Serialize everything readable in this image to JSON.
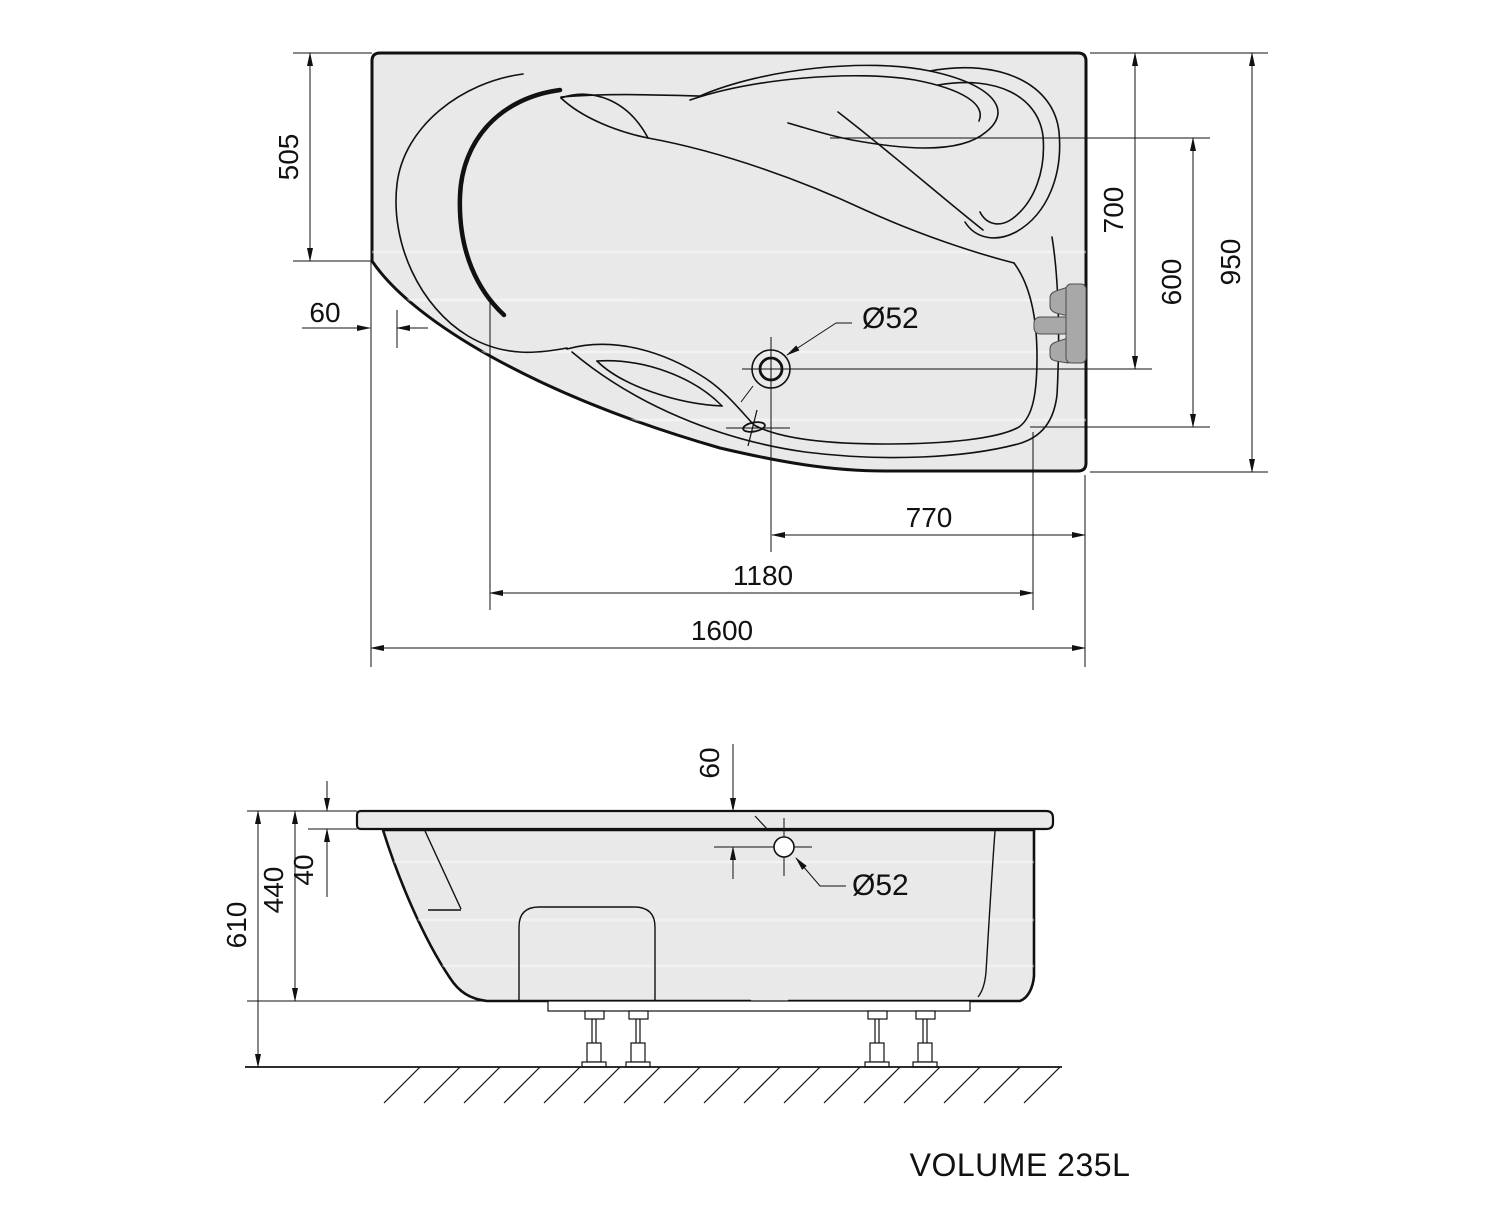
{
  "plan": {
    "d505": "505",
    "d60": "60",
    "d700": "700",
    "d600": "600",
    "d950": "950",
    "d770": "770",
    "d1180": "1180",
    "d1600": "1600",
    "dia": "Ø52"
  },
  "side": {
    "d60": "60",
    "d40": "40",
    "d440": "440",
    "d610": "610",
    "dia": "Ø52"
  },
  "footer": {
    "volume": "VOLUME 235L"
  },
  "colors": {
    "line": "#111111",
    "tub_fill": "#e9e9e9",
    "fixture_fill": "#a8a8a8",
    "background": "#ffffff"
  }
}
